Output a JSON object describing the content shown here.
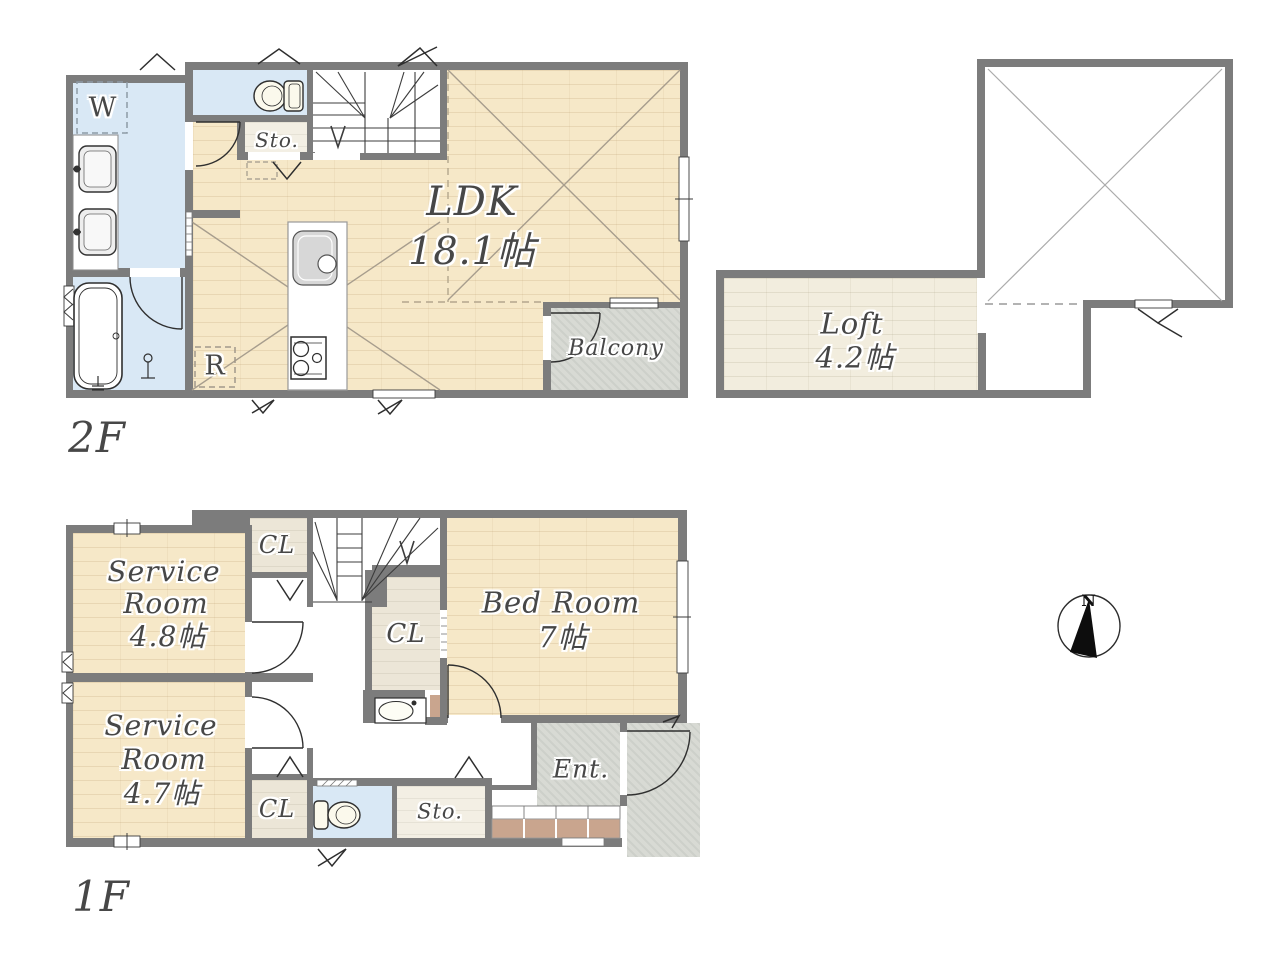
{
  "plan": {
    "floor2": {
      "label": "2F",
      "washer_mark": "W",
      "storage": "Sto.",
      "ldk": "LDK",
      "ldk_size": "18.1帖",
      "balcony": "Balcony",
      "fridge_mark": "R"
    },
    "loft": {
      "name": "Loft",
      "size": "4.2帖"
    },
    "floor1": {
      "label": "1F",
      "closet_top": "CL",
      "closet_mid": "CL",
      "closet_bottom": "CL",
      "service_room_1": {
        "line1": "Service",
        "line2": "Room",
        "size": "4.8帖"
      },
      "service_room_2": {
        "line1": "Service",
        "line2": "Room",
        "size": "4.7帖"
      },
      "bedroom": {
        "name": "Bed Room",
        "size": "7帖"
      },
      "storage": "Sto.",
      "entrance": "Ent."
    },
    "compass": {
      "north": "N"
    },
    "colors": {
      "wall": "#7c7c7c",
      "wood_floor": "#f6e8c8",
      "loft_floor": "#f2edde",
      "water_blue": "#d9e8f5",
      "outdoor_grey": "#d8dad4",
      "tile_brown": "#c9a58e",
      "text": "#474747"
    }
  }
}
